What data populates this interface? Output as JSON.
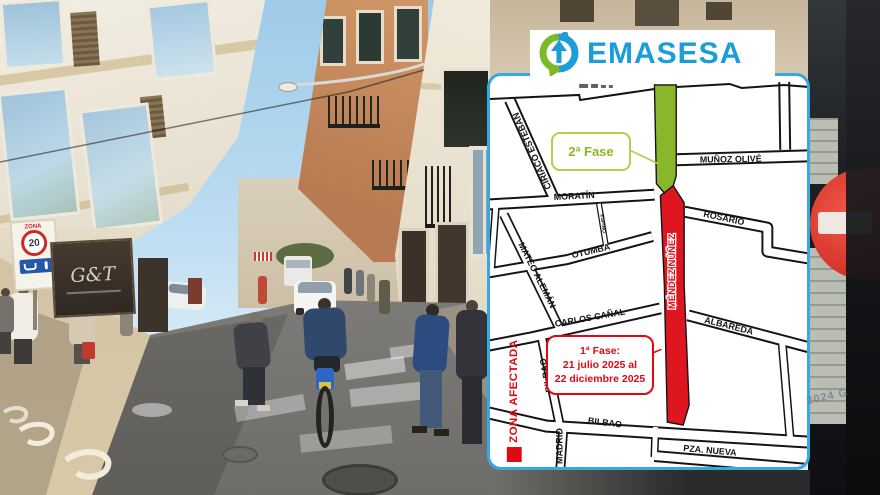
{
  "scene": {
    "watermark": "2024 G",
    "zone_sign": {
      "title": "ZONA",
      "speed": "20"
    },
    "storefront_logo": "G&T",
    "colors": {
      "sky": "#aed3ec",
      "road": "#87868a",
      "sidewalk": "#d2c2a3",
      "no_entry": "#e23b2e"
    }
  },
  "logo": {
    "text": "EMASESA",
    "blue": "#1b9dd9",
    "green": "#7cb928",
    "icon": "recycle-arrows-icon"
  },
  "map": {
    "border_color": "#36a9e0",
    "legend": {
      "label": "ZONA AFECTADA",
      "color": "#e30613",
      "icon": "red-square-swatch"
    },
    "phase1": {
      "line1": "1ª Fase:",
      "line2": "21 julio 2025 al",
      "line3": "22 diciembre 2025",
      "color": "#e30613"
    },
    "phase2": {
      "label": "2ª Fase",
      "color": "#8cb724"
    },
    "streets": {
      "ciriaco_esteban": "CIRIACO ESTEBAN",
      "munoz_olive": "MUÑOZ OLIVÉ",
      "moratin": "MORATÍN",
      "rosario": "ROSARIO",
      "otumba": "OTUMBA",
      "mateo_aleman": "MATEO ALEMÁN",
      "espino": "ESPINO",
      "mendez_nunez": "MÉNDEZ NÚÑEZ",
      "carlos_canal": "CARLOS CAÑAL",
      "albareda": "ALBAREDA",
      "bilbao_vertical": "BILBAO",
      "bilbao_bottom": "BILBAO",
      "madrid": "MADRID",
      "pza_nueva": "PZA. NUEVA"
    }
  }
}
